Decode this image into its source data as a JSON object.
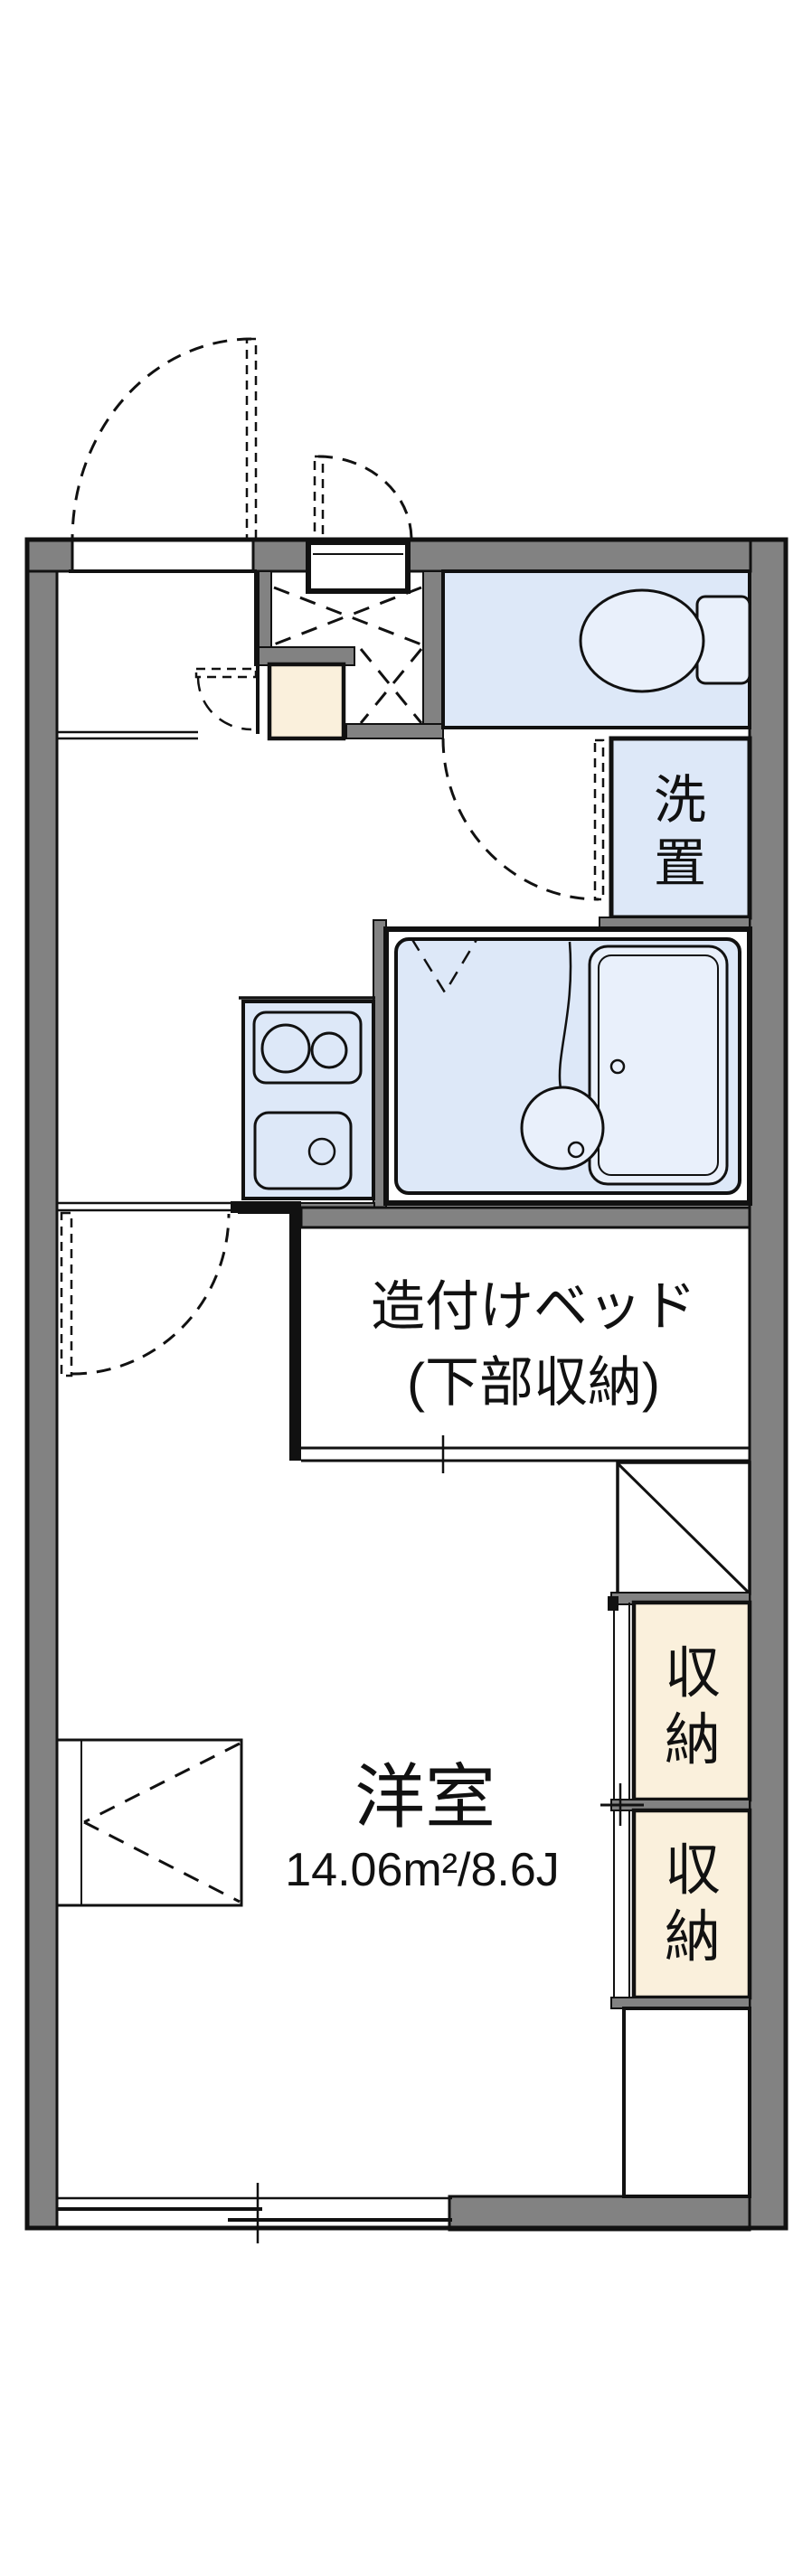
{
  "floorplan": {
    "rooms": {
      "western_room": {
        "name_label": "洋室",
        "area_label": "14.06m²/8.6J"
      },
      "built_in_bed": {
        "line1": "造付けベッド",
        "line2": "(下部収納)"
      },
      "washer_space": {
        "label": "洗置",
        "char_1": "洗",
        "char_2": "置"
      },
      "closet_upper": {
        "label": "収納",
        "char_1": "収",
        "char_2": "納"
      },
      "closet_lower": {
        "label": "収納",
        "char_1": "収",
        "char_2": "納"
      }
    },
    "colors": {
      "wall_gray": "#828282",
      "water_area_blue": "#dde8f8",
      "fixture_blue": "#e9f0fb",
      "closet_cream": "#faf0dc",
      "line_black": "#111111",
      "background": "#ffffff"
    }
  }
}
